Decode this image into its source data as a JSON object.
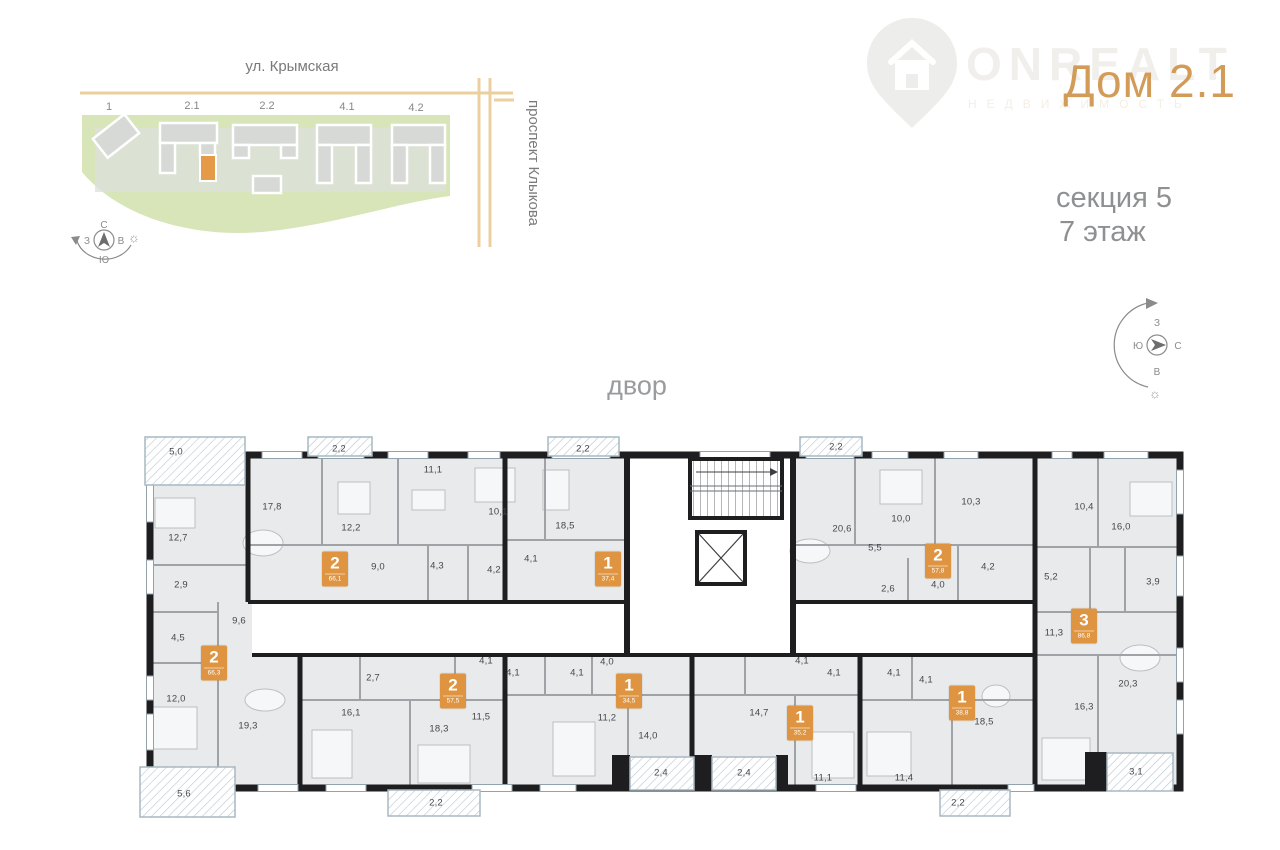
{
  "header": {
    "logo": {
      "brand": "ONREALT",
      "tagline": "НЕДВИЖИМОСТЬ"
    },
    "title": "Дом 2.1",
    "section_label": "секция 5",
    "floor_label": "7 этаж"
  },
  "site_plan": {
    "street_top": "ул. Крымская",
    "street_right": "проспект Клыкова",
    "building_labels": [
      {
        "t": "1",
        "x": 109,
        "y": 107
      },
      {
        "t": "2.1",
        "x": 192,
        "y": 106
      },
      {
        "t": "2.2",
        "x": 267,
        "y": 106
      },
      {
        "t": "4.1",
        "x": 347,
        "y": 107
      },
      {
        "t": "4.2",
        "x": 416,
        "y": 108
      }
    ],
    "compass": {
      "n": "С",
      "s": "Ю",
      "w": "З",
      "e": "В"
    }
  },
  "compass_right": {
    "top": "З",
    "left": "Ю",
    "right": "С",
    "bottom": "В"
  },
  "plan": {
    "yard_label": "двор",
    "rooms": [
      {
        "t": "5,0",
        "x": 176,
        "y": 452
      },
      {
        "t": "2,2",
        "x": 339,
        "y": 449
      },
      {
        "t": "2,2",
        "x": 583,
        "y": 449
      },
      {
        "t": "2,2",
        "x": 836,
        "y": 447
      },
      {
        "t": "12,7",
        "x": 178,
        "y": 538
      },
      {
        "t": "17,8",
        "x": 272,
        "y": 507
      },
      {
        "t": "12,2",
        "x": 351,
        "y": 528
      },
      {
        "t": "11,1",
        "x": 433,
        "y": 470
      },
      {
        "t": "9,0",
        "x": 378,
        "y": 567
      },
      {
        "t": "4,3",
        "x": 437,
        "y": 566
      },
      {
        "t": "4,2",
        "x": 494,
        "y": 570
      },
      {
        "t": "10,1",
        "x": 498,
        "y": 512
      },
      {
        "t": "18,5",
        "x": 565,
        "y": 526
      },
      {
        "t": "4,1",
        "x": 531,
        "y": 559
      },
      {
        "t": "20,6",
        "x": 842,
        "y": 529
      },
      {
        "t": "10,0",
        "x": 901,
        "y": 519
      },
      {
        "t": "10,3",
        "x": 971,
        "y": 502
      },
      {
        "t": "5,5",
        "x": 875,
        "y": 548
      },
      {
        "t": "2,6",
        "x": 888,
        "y": 589
      },
      {
        "t": "4,0",
        "x": 938,
        "y": 585
      },
      {
        "t": "4,2",
        "x": 988,
        "y": 567
      },
      {
        "t": "10,4",
        "x": 1084,
        "y": 507
      },
      {
        "t": "16,0",
        "x": 1121,
        "y": 527
      },
      {
        "t": "5,2",
        "x": 1051,
        "y": 577
      },
      {
        "t": "3,9",
        "x": 1153,
        "y": 582
      },
      {
        "t": "2,9",
        "x": 181,
        "y": 585
      },
      {
        "t": "9,6",
        "x": 239,
        "y": 621
      },
      {
        "t": "4,5",
        "x": 178,
        "y": 638
      },
      {
        "t": "11,3",
        "x": 1054,
        "y": 633
      },
      {
        "t": "12,0",
        "x": 176,
        "y": 699
      },
      {
        "t": "19,3",
        "x": 248,
        "y": 726
      },
      {
        "t": "5,6",
        "x": 184,
        "y": 794
      },
      {
        "t": "2,7",
        "x": 373,
        "y": 678
      },
      {
        "t": "16,1",
        "x": 351,
        "y": 713
      },
      {
        "t": "18,3",
        "x": 439,
        "y": 729
      },
      {
        "t": "4,1",
        "x": 486,
        "y": 661
      },
      {
        "t": "11,5",
        "x": 481,
        "y": 717
      },
      {
        "t": "2,2",
        "x": 436,
        "y": 803
      },
      {
        "t": "4,1",
        "x": 513,
        "y": 673
      },
      {
        "t": "4,1",
        "x": 577,
        "y": 673
      },
      {
        "t": "4,0",
        "x": 607,
        "y": 662
      },
      {
        "t": "11,2",
        "x": 607,
        "y": 718
      },
      {
        "t": "14,0",
        "x": 648,
        "y": 736
      },
      {
        "t": "2,4",
        "x": 661,
        "y": 773
      },
      {
        "t": "14,7",
        "x": 759,
        "y": 713
      },
      {
        "t": "2,4",
        "x": 744,
        "y": 773
      },
      {
        "t": "4,1",
        "x": 802,
        "y": 661
      },
      {
        "t": "4,1",
        "x": 834,
        "y": 673
      },
      {
        "t": "11,1",
        "x": 823,
        "y": 778
      },
      {
        "t": "4,1",
        "x": 894,
        "y": 673
      },
      {
        "t": "4,1",
        "x": 926,
        "y": 680
      },
      {
        "t": "18,5",
        "x": 984,
        "y": 722
      },
      {
        "t": "11,4",
        "x": 904,
        "y": 778
      },
      {
        "t": "2,2",
        "x": 958,
        "y": 803
      },
      {
        "t": "20,3",
        "x": 1128,
        "y": 684
      },
      {
        "t": "16,3",
        "x": 1084,
        "y": 707
      },
      {
        "t": "3,1",
        "x": 1136,
        "y": 772
      }
    ],
    "apartments": [
      {
        "rooms": "2",
        "area": "66,1",
        "x": 335,
        "y": 569
      },
      {
        "rooms": "1",
        "area": "37,4",
        "x": 608,
        "y": 569
      },
      {
        "rooms": "2",
        "area": "57,8",
        "x": 938,
        "y": 561
      },
      {
        "rooms": "3",
        "area": "86,8",
        "x": 1084,
        "y": 626
      },
      {
        "rooms": "2",
        "area": "66,3",
        "x": 214,
        "y": 663
      },
      {
        "rooms": "2",
        "area": "57,5",
        "x": 453,
        "y": 691
      },
      {
        "rooms": "1",
        "area": "34,5",
        "x": 629,
        "y": 691
      },
      {
        "rooms": "1",
        "area": "35,2",
        "x": 800,
        "y": 723
      },
      {
        "rooms": "1",
        "area": "38,8",
        "x": 962,
        "y": 703
      }
    ]
  },
  "colors": {
    "accent_orange": "#de9440",
    "title_tan": "#d29b58",
    "street_tan": "#eccf9f",
    "site_green": "#d8e5b8",
    "wall_dark": "#1e1e20",
    "plan_fill": "#e8eaec"
  }
}
